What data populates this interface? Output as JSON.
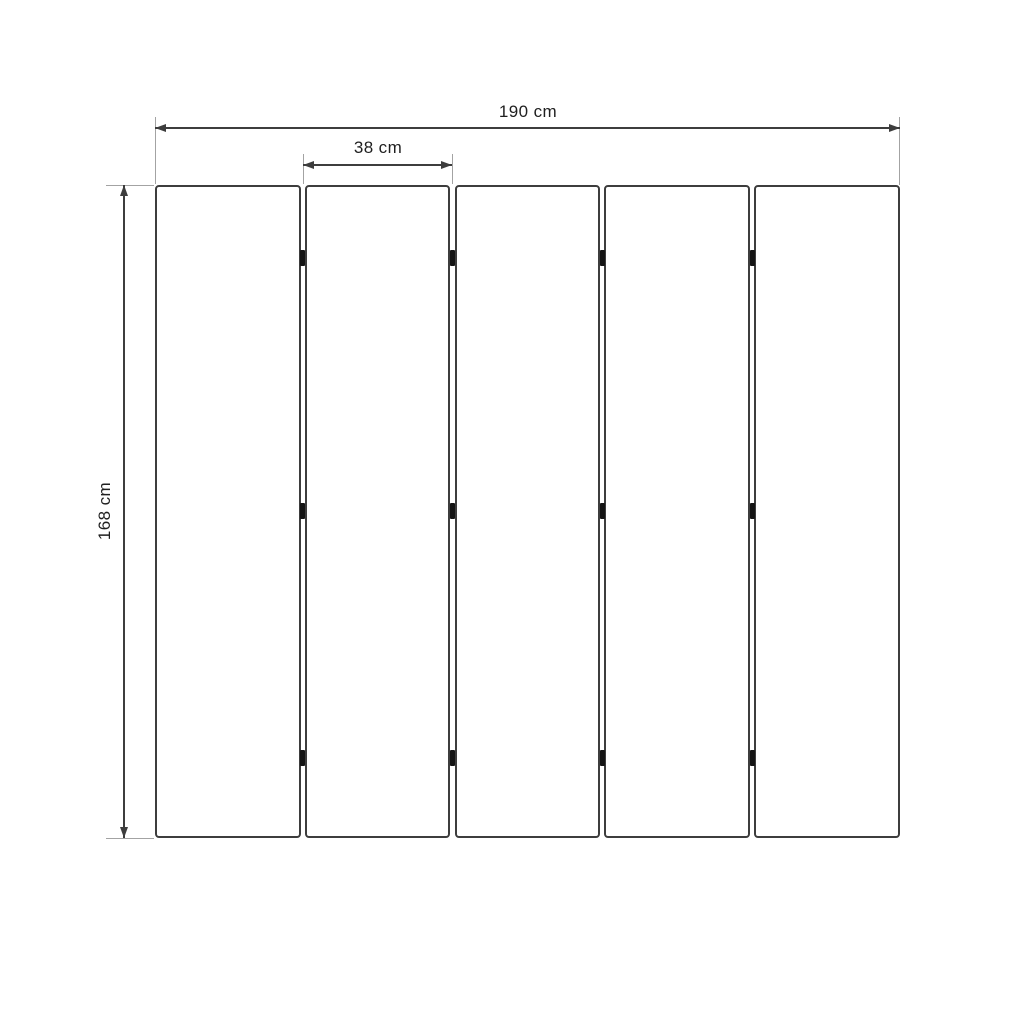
{
  "diagram": {
    "type": "panel-dimension-drawing",
    "panel_count": 5,
    "hinge_rows": 3,
    "dimensions": {
      "total_width": "190 cm",
      "panel_width": "38 cm",
      "height": "168 cm"
    }
  },
  "colors": {
    "background": "#ffffff",
    "line": "#3d3d3d",
    "extension": "#a3a3a3",
    "hinge": "#141414",
    "text": "#1f1f1f"
  }
}
